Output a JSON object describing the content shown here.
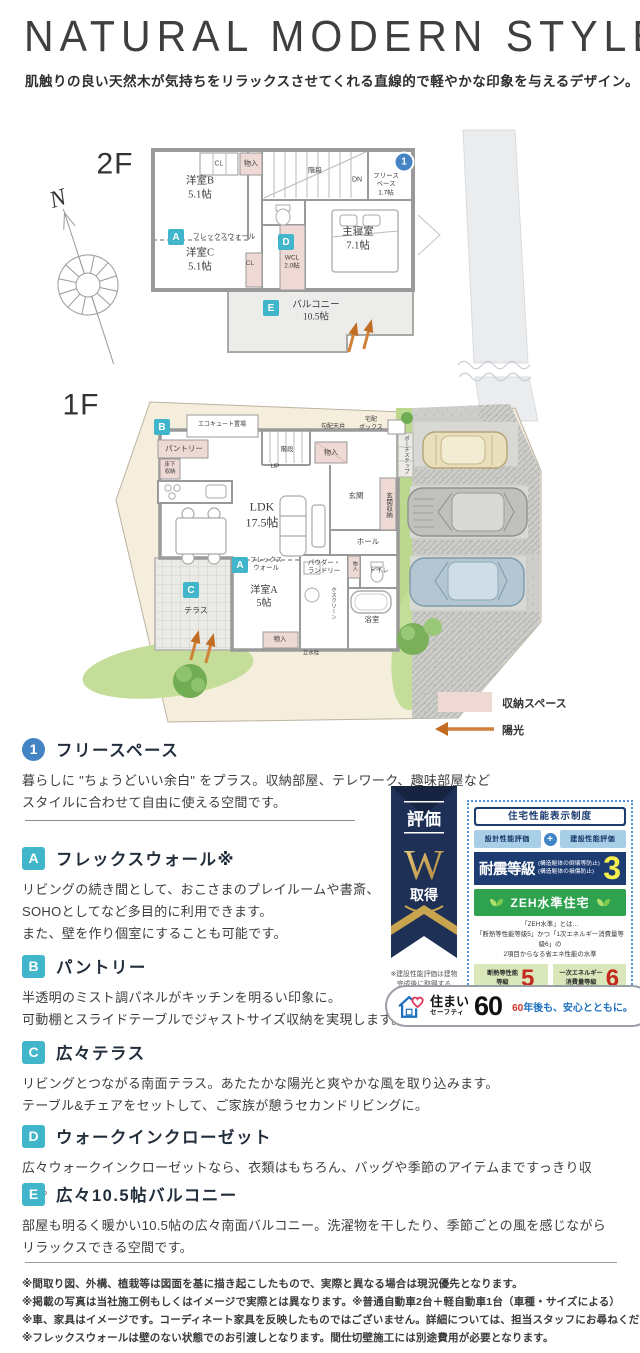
{
  "header": {
    "title": "NATURAL MODERN STYLE",
    "subtitle": "肌触りの良い天然木が気持ちをリラックスさせてくれる直線的で軽やかな印象を与えるデザイン。"
  },
  "colors": {
    "accent_cyan": "#41b6ca",
    "accent_blue": "#4584c4",
    "storage_pink": "#eed9d4",
    "navy": "#1c3c72",
    "zeh_green": "#2ea24e",
    "sun_orange": "#d08038"
  },
  "plan2f": {
    "floor_label": "2F",
    "north_label": "N",
    "marker_1": "1",
    "marker_a": "A",
    "marker_d": "D",
    "marker_e": "E",
    "rooms": {
      "cl_top": "CL",
      "monoire_top": "物入",
      "stairs": "階段",
      "dn": "DN",
      "free_space": "フリース\nペース\n1.7帖",
      "yoshitsu_b": "洋室B\n5.1帖",
      "flex_wall": "フレックスウォール",
      "yoshitsu_c": "洋室C\n5.1帖",
      "cl_mid": "CL",
      "wcl": "WCL\n2.0帖",
      "shushinshitsu": "主寝室\n7.1帖",
      "balcony": "バルコニー\n10.5帖"
    }
  },
  "plan1f": {
    "floor_label": "1F",
    "marker_a": "A",
    "marker_b": "B",
    "marker_c": "C",
    "rooms": {
      "ecocute": "エコキュート置場",
      "pantry": "パントリー",
      "yukashita": "床下\n収納",
      "kobai_tenjo": "勾配天井",
      "monoire_top": "物入",
      "stairs": "階段",
      "up": "UP",
      "takuhai": "宅配\nボックス",
      "porch_step": "ポーチステップ",
      "ldk": "LDK\n17.5帖",
      "genkan": "玄関",
      "genkan_shuno": "玄関収納",
      "hall": "ホール",
      "flex_wall": "フレックス\nウォール",
      "yoshitsu_a": "洋室A\n5帖",
      "powder": "パウダー・\nランドリー",
      "monoire_mid": "物入",
      "toilet": "トイレ",
      "hosuclean": "ホスクリーン",
      "bathroom": "浴室",
      "monoire_bottom": "物入",
      "rissuisen": "立水栓",
      "terrace": "テラス"
    }
  },
  "legend": {
    "storage": "収納スペース",
    "sunlight": "陽光"
  },
  "features": [
    {
      "marker": "1",
      "title": "フリースペース",
      "body": "暮らしに \"ちょうどいい余白\" をプラス。収納部屋、テレワーク、趣味部屋など\nスタイルに合わせて自由に使える空間です。"
    },
    {
      "marker": "A",
      "title": "フレックスウォール※",
      "body": "リビングの続き間として、おこさまのプレイルームや書斎、\nSOHOとしてなど多目的に利用できます。\nまた、壁を作り個室にすることも可能です。"
    },
    {
      "marker": "B",
      "title": "パントリー",
      "body": "半透明のミスト調パネルがキッチンを明るい印象に。\n可動棚とスライドテーブルでジャストサイズ収納を実現します。"
    },
    {
      "marker": "C",
      "title": "広々テラス",
      "body": "リビングとつながる南面テラス。あたたかな陽光と爽やかな風を取り込みます。\nテーブル&チェアをセットして、ご家族が憩うセカンドリビングに。"
    },
    {
      "marker": "D",
      "title": "ウォークインクローゼット",
      "body": "広々ウォークインクローゼットなら、衣類はもちろん、バッグや季節のアイテムまですっきり収納。。"
    },
    {
      "marker": "E",
      "title": "広々10.5帖バルコニー",
      "body": "部屋も明るく暖かい10.5帖の広々南面バルコニー。洗濯物を干したり、季節ごとの風を感じながら\nリラックスできる空間です。"
    }
  ],
  "certification": {
    "ribbon": {
      "hyoka": "評価",
      "w": "W",
      "shutoku": "取得",
      "note": "※建設性能評価は建物\n完成後に取得する"
    },
    "panel": {
      "system_title": "住宅性能表示制度",
      "design_eval": "設計性能評価",
      "plus": "+",
      "construction_eval": "建設性能評価",
      "taishin_label": "耐震等級",
      "taishin_sub1": "(構造躯体の倒壊等防止)",
      "taishin_sub2": "(構造躯体の損傷防止)",
      "taishin_grade": "3",
      "zeh_label": "ZEH水準住宅",
      "zeh_note1": "「ZEH水準」とは…",
      "zeh_note2": "「断熱等性能等級5」かつ「1次エネルギー消費量等級6」の",
      "zeh_note3": "2項目からなる省エネ性能の水準",
      "dannetsu_label": "断熱等性能\n等級",
      "dannetsu_grade": "5",
      "energy_label": "一次エネルギー\n消費量等級",
      "energy_grade": "6"
    },
    "safety": {
      "sumai": "住まい",
      "safety_word": "セーフティ",
      "num": "60",
      "slogan_num": "60",
      "slogan_text": "年後も、安心とともに。"
    }
  },
  "footnotes": [
    "※間取り図、外構、植栽等は図面を基に描き起こしたもので、実際と異なる場合は現況優先となります。",
    "※掲載の写真は当社施工例もしくはイメージで実際とは異なります。※普通自動車2台＋軽自動車1台（車種・サイズによる）",
    "※車、家具はイメージです。コーディネート家具を反映したものではございません。詳細については、担当スタッフにお尋ねください。",
    "※フレックスウォールは壁のない状態でのお引渡しとなります。間仕切壁施工には別途費用が必要となります。"
  ]
}
